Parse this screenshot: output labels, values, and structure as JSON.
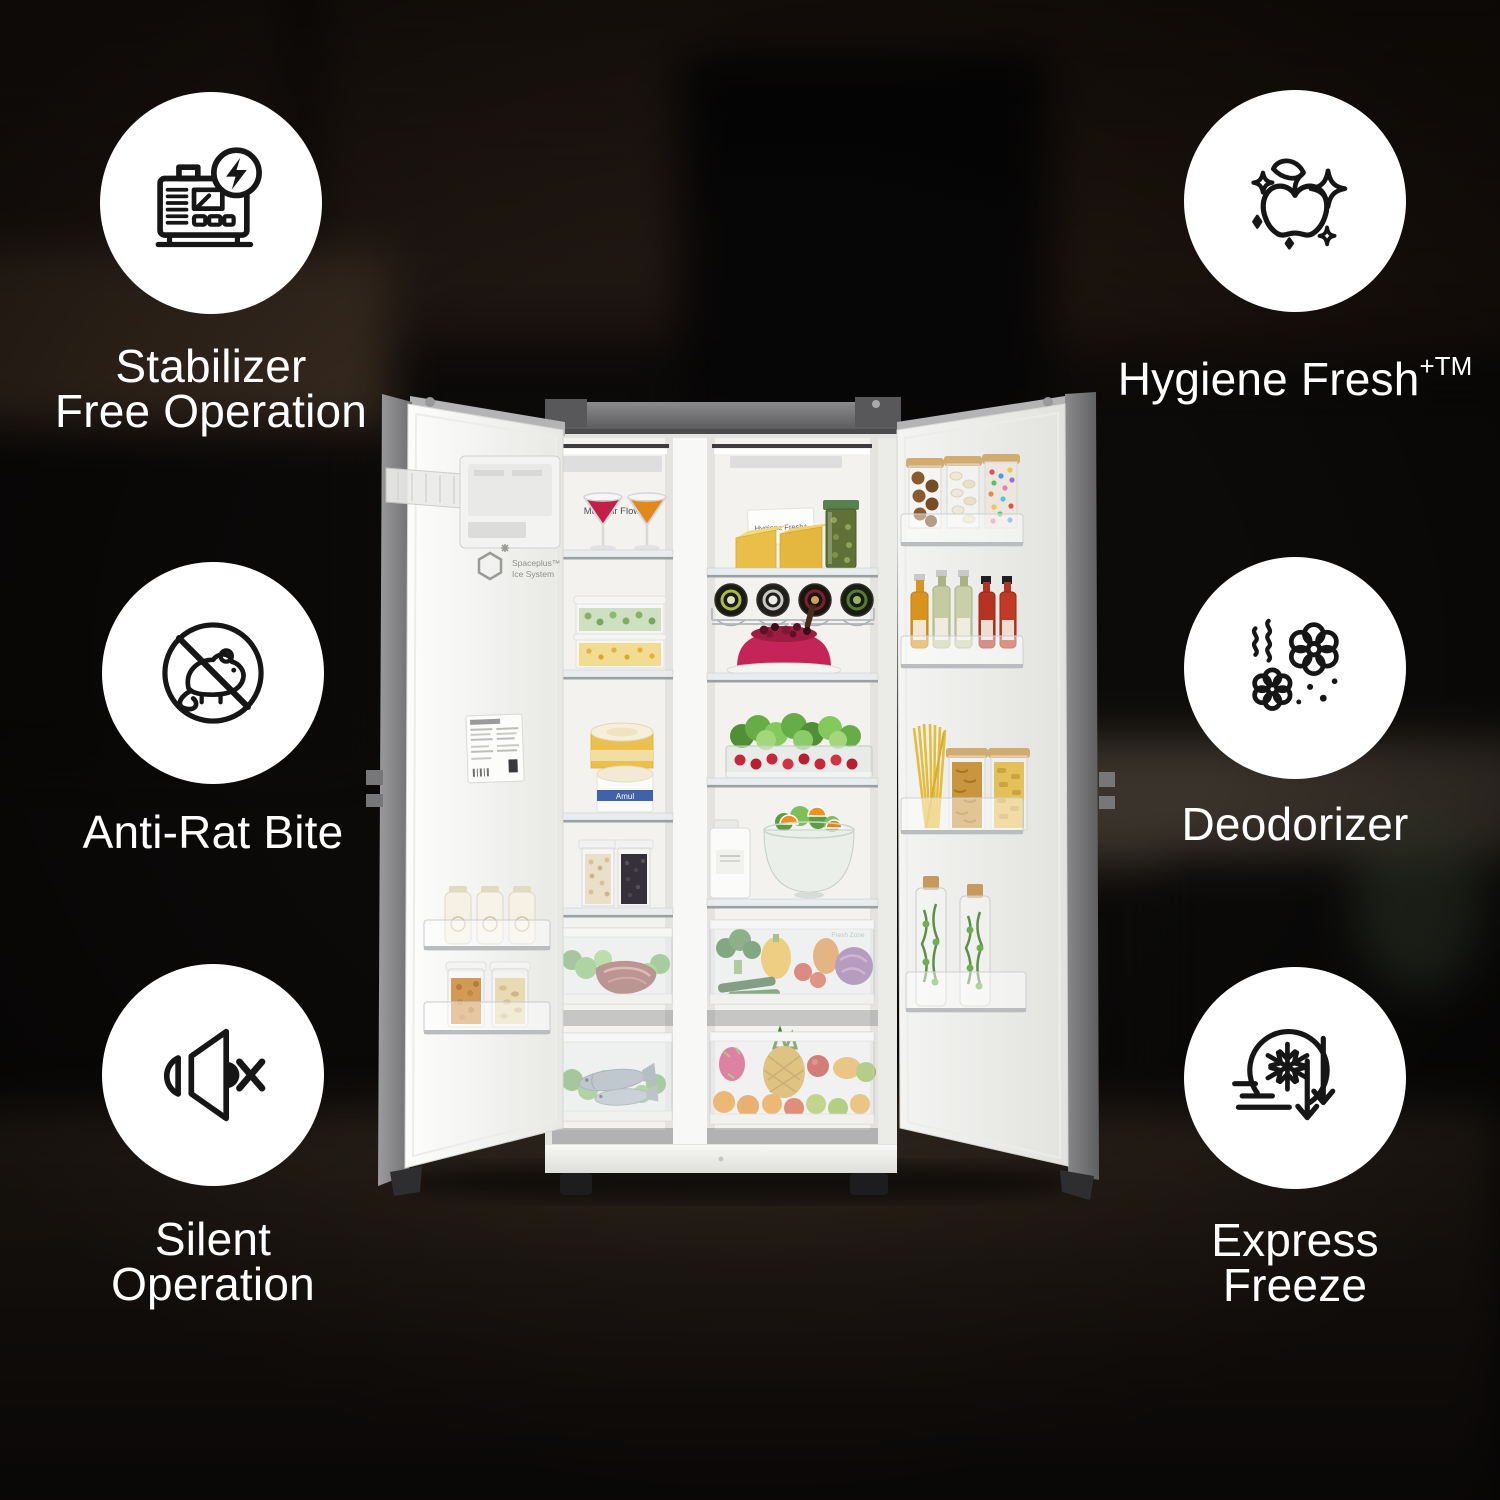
{
  "features": {
    "left": [
      {
        "icon": "stabilizer-icon",
        "lines": [
          "Stabilizer",
          "Free Operation"
        ]
      },
      {
        "icon": "anti-rat-icon",
        "lines": [
          "Anti-Rat Bite"
        ]
      },
      {
        "icon": "speaker-mute-icon",
        "lines": [
          "Silent",
          "Operation"
        ]
      }
    ],
    "right": [
      {
        "icon": "apple-sparkles-icon",
        "lines": [
          "Hygiene Fresh"
        ],
        "sup": "+TM"
      },
      {
        "icon": "deodorizer-flowers-icon",
        "lines": [
          "Deodorizer"
        ]
      },
      {
        "icon": "express-freeze-icon",
        "lines": [
          "Express",
          "Freeze"
        ]
      }
    ]
  },
  "fridge": {
    "freezer_back_label": "Multi Air Flow",
    "ice_system_line1": "Spaceplus™",
    "ice_system_line2": "Ice System",
    "hygiene_card": "Hygiene Fresh⁺",
    "drawer_label": "Fresh Zone",
    "tub_brand": "Amul"
  },
  "style": {
    "badge_background": "#ffffff",
    "icon_stroke": "#161616",
    "label_color": "#ffffff",
    "background_base": "#0c0a09"
  }
}
